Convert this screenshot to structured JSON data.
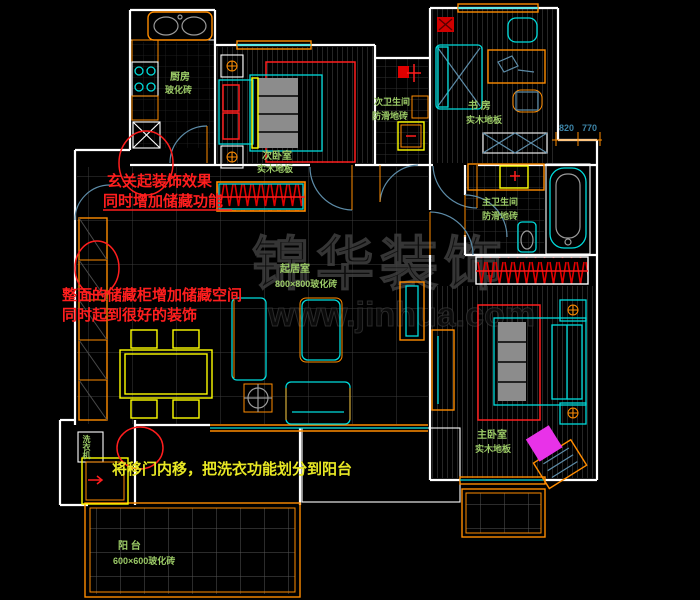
{
  "watermark": {
    "line1": "锦华装饰",
    "line2": "www.jinhua.com"
  },
  "rooms": {
    "kitchen": {
      "name": "厨房",
      "material": "玻化砖"
    },
    "second_bedroom": {
      "name": "次卧室",
      "material": "实木地板"
    },
    "second_bathroom": {
      "name": "次卫生间",
      "material": "防滑地砖"
    },
    "study": {
      "name": "书 房",
      "material": "实木地板"
    },
    "master_bathroom": {
      "name": "主卫生间",
      "material": "防滑地砖"
    },
    "living_dining": {
      "name": "起居室",
      "material": "800×800玻化砖"
    },
    "master_bedroom": {
      "name": "主卧室",
      "material": "实木地板"
    },
    "balcony": {
      "name": "阳 台",
      "material": "600×600玻化砖"
    },
    "laundry": {
      "name": "洗衣机"
    }
  },
  "annotations": {
    "entry_line1": "玄关起装饰效果",
    "entry_line2": "同时增加储藏功能",
    "cabinet_line1": "整面的储藏柜增加储藏空间",
    "cabinet_line2": "同时起到很好的装饰",
    "laundry_note": "将移门内移，把洗衣功能划分到阳台"
  },
  "dimensions": {
    "left": "820",
    "right": "770"
  },
  "colors": {
    "background": "#000000",
    "wall_white": "#ffffff",
    "furniture_orange": "#ff8c00",
    "furniture_cyan": "#00dcdc",
    "annotation_red": "#ff1e1e",
    "annotation_yellow": "#e8e824",
    "label_green": "#9ccb67",
    "dimension_blue": "#3d85a8",
    "door_arc_blue": "#5d8ca8",
    "highlight_magenta": "#e832e8"
  }
}
